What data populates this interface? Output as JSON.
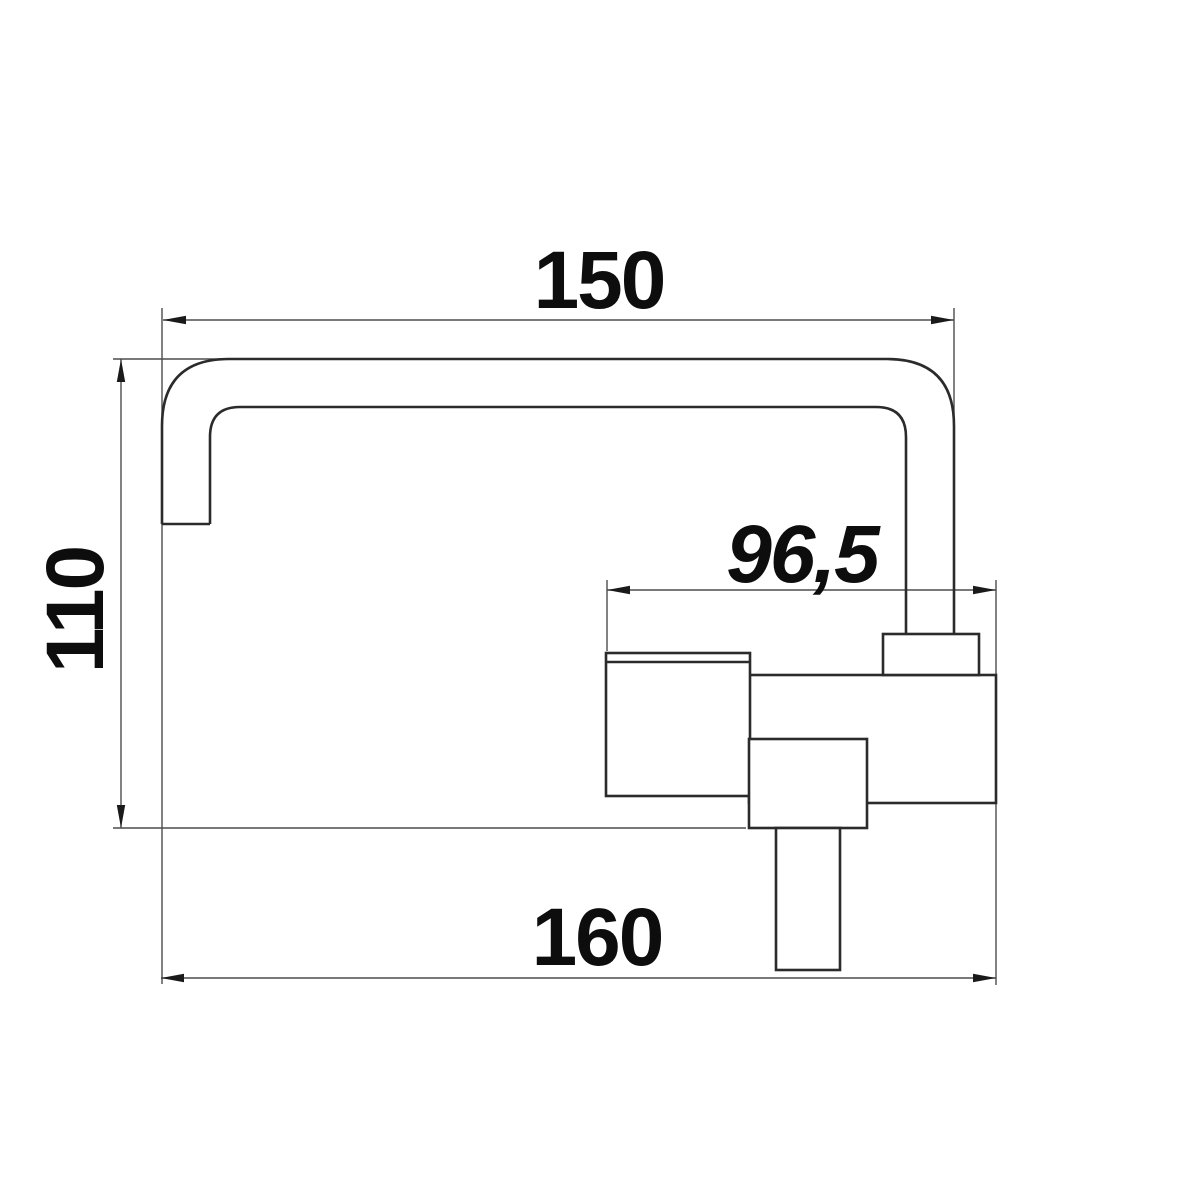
{
  "drawing": {
    "title": "faucet-dimension-drawing",
    "dimensions": {
      "top": "150",
      "left": "110",
      "middle": "96,5",
      "bottom": "160"
    },
    "colors": {
      "background": "#ffffff",
      "outline": "#2b2b2b",
      "dimension_lines": "#4d4d4d",
      "arrowheads": "#1a1a1a",
      "text": "#0d0d0d"
    }
  }
}
